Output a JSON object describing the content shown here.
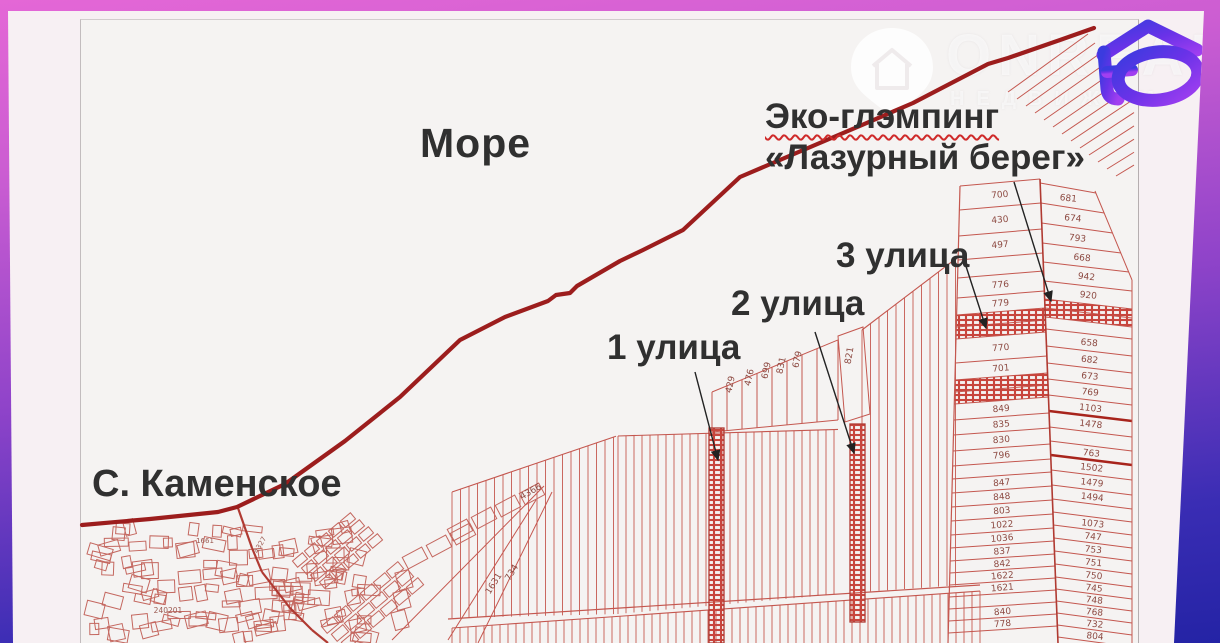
{
  "labels": {
    "sea": "Море",
    "glamping_line1": "Эко-глэмпинг",
    "glamping_line2": "«Лазурный берег»",
    "street1": "1 улица",
    "street2": "2 улица",
    "street3": "3 улица",
    "village": "С. Каменское"
  },
  "watermark": {
    "brand": "ONREAL",
    "subtitle": "НЕДВИЖИМ",
    "icon": "house-pin-icon"
  },
  "logo_icon": "onrealt-house-logo",
  "colors": {
    "coastline": "#9c1d1d",
    "parcel_line": "#c4574f",
    "parcel_number": "#8d4a42",
    "frame_top": "#e467d6",
    "frame_bottom": "#2423a5",
    "logo_blue": "#3b3bdf",
    "logo_purple": "#a13ff0",
    "label_text": "#303030",
    "underline_red": "#cf2a2a"
  },
  "parcels": {
    "left_column_rows": [
      "700",
      "430",
      "497",
      "",
      "776",
      "779",
      "#",
      "#",
      "770",
      "701",
      "#",
      "#",
      "849",
      "835",
      "830",
      "796",
      "",
      "847",
      "848",
      "803",
      "1022",
      "1036",
      "837",
      "842",
      "1622",
      "1621",
      "",
      "840",
      "778"
    ],
    "right_column_rows": [
      "681",
      "674",
      "793",
      "668",
      "942",
      "920",
      "#",
      "#",
      "",
      "658",
      "682",
      "673",
      "769",
      "1103",
      "1478",
      "",
      "763",
      "1502",
      "1479",
      "1494",
      "",
      "1073",
      "747",
      "753",
      "751",
      "750",
      "745",
      "748",
      "768",
      "732",
      "804"
    ],
    "field_numbers": [
      "429",
      "476",
      "699",
      "831",
      "679"
    ],
    "wide_field_number": "821",
    "diagonal_numbers": [
      "4366",
      "1631",
      "734"
    ],
    "village_numbers": [
      "1661",
      "4327",
      "240201"
    ]
  }
}
